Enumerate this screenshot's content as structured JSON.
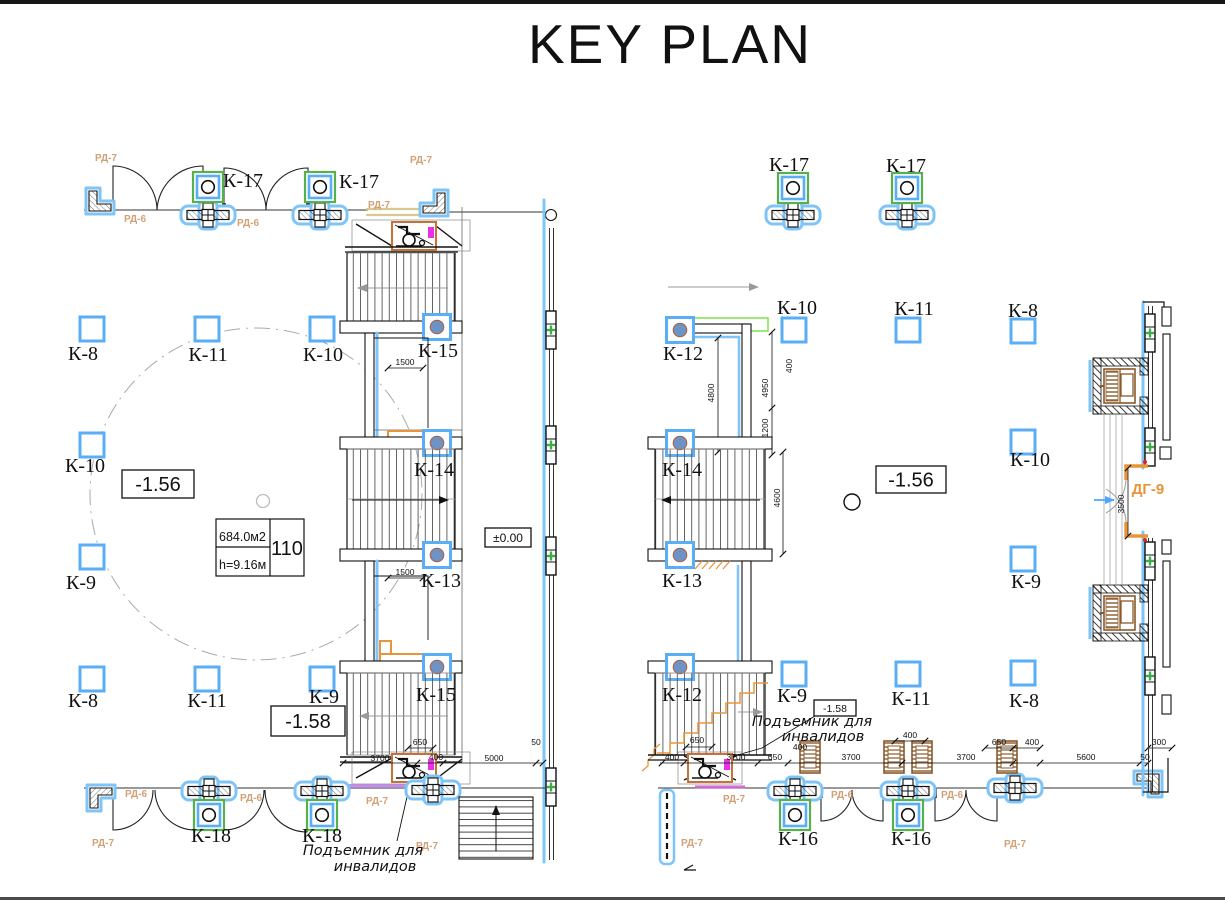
{
  "title": "KEY PLAN",
  "colors": {
    "grid_blue": "#5aaef5",
    "halo_blue": "#7fc4f7",
    "green": "#56b04c",
    "lime": "#7ee24c",
    "tan_label": "#d2a276",
    "tan_wall": "#d8c98e",
    "orange": "#e8953a",
    "brown": "#8B5A2B",
    "magenta": "#e830e8",
    "violet": "#b57edc"
  },
  "room_tag": {
    "area": "684.0м2",
    "height": "h=9.16м",
    "number": "110"
  },
  "elevation_boxes": [
    {
      "text": "-1.56",
      "x": 122,
      "y": 470,
      "w": 72,
      "h": 28,
      "cls": "big"
    },
    {
      "text": "-1.58",
      "x": 271,
      "y": 706,
      "w": 74,
      "h": 30,
      "cls": "big"
    },
    {
      "text": "±0.00",
      "x": 485,
      "y": 528,
      "w": 46,
      "h": 19,
      "cls": "small"
    },
    {
      "text": "-1.56",
      "x": 876,
      "y": 466,
      "w": 70,
      "h": 27,
      "cls": "big"
    },
    {
      "text": "-1.58",
      "x": 814,
      "y": 700,
      "w": 42,
      "h": 16,
      "cls": "tiny"
    }
  ],
  "labels": [
    {
      "t": "К-17",
      "x": 243,
      "y": 187,
      "c": "k"
    },
    {
      "t": "К-17",
      "x": 359,
      "y": 188,
      "c": "k"
    },
    {
      "t": "РД-7",
      "x": 95,
      "y": 161,
      "c": "rd"
    },
    {
      "t": "РД-7",
      "x": 410,
      "y": 163,
      "c": "rd"
    },
    {
      "t": "РД-6",
      "x": 124,
      "y": 222,
      "c": "rd"
    },
    {
      "t": "РД-6",
      "x": 237,
      "y": 226,
      "c": "rd"
    },
    {
      "t": "РД-7",
      "x": 368,
      "y": 208,
      "c": "rd"
    },
    {
      "t": "К-8",
      "x": 83,
      "y": 360,
      "c": "k"
    },
    {
      "t": "К-11",
      "x": 208,
      "y": 361,
      "c": "k"
    },
    {
      "t": "К-10",
      "x": 323,
      "y": 361,
      "c": "k"
    },
    {
      "t": "К-15",
      "x": 438,
      "y": 357,
      "c": "k"
    },
    {
      "t": "К-10",
      "x": 85,
      "y": 472,
      "c": "k"
    },
    {
      "t": "К-14",
      "x": 434,
      "y": 476,
      "c": "k"
    },
    {
      "t": "К-9",
      "x": 81,
      "y": 589,
      "c": "k"
    },
    {
      "t": "К-13",
      "x": 441,
      "y": 587,
      "c": "k"
    },
    {
      "t": "К-8",
      "x": 83,
      "y": 707,
      "c": "k"
    },
    {
      "t": "К-11",
      "x": 207,
      "y": 707,
      "c": "k"
    },
    {
      "t": "К-9",
      "x": 324,
      "y": 703,
      "c": "k"
    },
    {
      "t": "К-15",
      "x": 436,
      "y": 701,
      "c": "k"
    },
    {
      "t": "К-18",
      "x": 211,
      "y": 842,
      "c": "k"
    },
    {
      "t": "К-18",
      "x": 322,
      "y": 842,
      "c": "k"
    },
    {
      "t": "РД-6",
      "x": 125,
      "y": 797,
      "c": "rd"
    },
    {
      "t": "РД-6",
      "x": 240,
      "y": 801,
      "c": "rd"
    },
    {
      "t": "РД-7",
      "x": 366,
      "y": 804,
      "c": "rd"
    },
    {
      "t": "РД-7",
      "x": 92,
      "y": 846,
      "c": "rd"
    },
    {
      "t": "РД-7",
      "x": 416,
      "y": 849,
      "c": "rd"
    },
    {
      "t": "Подъемник для",
      "x": 363,
      "y": 855,
      "c": "hand"
    },
    {
      "t": "инвалидов",
      "x": 375,
      "y": 871,
      "c": "hand"
    },
    {
      "t": "1500",
      "x": 405,
      "y": 365,
      "c": "dim"
    },
    {
      "t": "1500",
      "x": 405,
      "y": 575,
      "c": "dim"
    },
    {
      "t": "650",
      "x": 420,
      "y": 745,
      "c": "dim"
    },
    {
      "t": "3700",
      "x": 380,
      "y": 761,
      "c": "dim"
    },
    {
      "t": "400",
      "x": 436,
      "y": 760,
      "c": "dim"
    },
    {
      "t": "5000",
      "x": 494,
      "y": 761,
      "c": "dim"
    },
    {
      "t": "50",
      "x": 536,
      "y": 745,
      "c": "dim"
    },
    {
      "t": "К-17",
      "x": 789,
      "y": 171,
      "c": "k"
    },
    {
      "t": "К-17",
      "x": 906,
      "y": 172,
      "c": "k"
    },
    {
      "t": "К-10",
      "x": 797,
      "y": 314,
      "c": "k"
    },
    {
      "t": "К-11",
      "x": 914,
      "y": 315,
      "c": "k"
    },
    {
      "t": "К-8",
      "x": 1023,
      "y": 317,
      "c": "k"
    },
    {
      "t": "К-12",
      "x": 683,
      "y": 360,
      "c": "k"
    },
    {
      "t": "К-14",
      "x": 682,
      "y": 476,
      "c": "k"
    },
    {
      "t": "К-10",
      "x": 1030,
      "y": 466,
      "c": "k"
    },
    {
      "t": "К-13",
      "x": 682,
      "y": 587,
      "c": "k"
    },
    {
      "t": "К-9",
      "x": 1026,
      "y": 588,
      "c": "k"
    },
    {
      "t": "К-12",
      "x": 682,
      "y": 701,
      "c": "k"
    },
    {
      "t": "К-9",
      "x": 792,
      "y": 702,
      "c": "k"
    },
    {
      "t": "К-11",
      "x": 911,
      "y": 705,
      "c": "k"
    },
    {
      "t": "К-8",
      "x": 1024,
      "y": 707,
      "c": "k"
    },
    {
      "t": "К-16",
      "x": 798,
      "y": 845,
      "c": "k"
    },
    {
      "t": "К-16",
      "x": 911,
      "y": 845,
      "c": "k"
    },
    {
      "t": "РД-7",
      "x": 723,
      "y": 802,
      "c": "rd"
    },
    {
      "t": "РД-6",
      "x": 831,
      "y": 798,
      "c": "rd"
    },
    {
      "t": "РД-6",
      "x": 941,
      "y": 798,
      "c": "rd"
    },
    {
      "t": "РД-7",
      "x": 681,
      "y": 846,
      "c": "rd"
    },
    {
      "t": "РД-7",
      "x": 1004,
      "y": 847,
      "c": "rd"
    },
    {
      "t": "ДГ-9",
      "x": 1148,
      "y": 494,
      "c": "dg"
    },
    {
      "t": "Подъемник для",
      "x": 812,
      "y": 726,
      "c": "hand"
    },
    {
      "t": "инвалидов",
      "x": 823,
      "y": 741,
      "c": "hand"
    },
    {
      "t": "400",
      "x": 672,
      "y": 760,
      "c": "dim"
    },
    {
      "t": "3700",
      "x": 736,
      "y": 760,
      "c": "dim"
    },
    {
      "t": "650",
      "x": 697,
      "y": 743,
      "c": "dim"
    },
    {
      "t": "650",
      "x": 775,
      "y": 760,
      "c": "dim"
    },
    {
      "t": "400",
      "x": 800,
      "y": 750,
      "c": "dim"
    },
    {
      "t": "3700",
      "x": 851,
      "y": 760,
      "c": "dim"
    },
    {
      "t": "400",
      "x": 910,
      "y": 738,
      "c": "dim"
    },
    {
      "t": "3700",
      "x": 966,
      "y": 760,
      "c": "dim"
    },
    {
      "t": "650",
      "x": 999,
      "y": 745,
      "c": "dim"
    },
    {
      "t": "400",
      "x": 1032,
      "y": 745,
      "c": "dim"
    },
    {
      "t": "5600",
      "x": 1086,
      "y": 760,
      "c": "dim"
    },
    {
      "t": "50",
      "x": 1145,
      "y": 760,
      "c": "dim"
    },
    {
      "t": "300",
      "x": 1159,
      "y": 745,
      "c": "dim"
    },
    {
      "t": "4800",
      "x": 714,
      "y": 393,
      "c": "dimr"
    },
    {
      "t": "4950",
      "x": 768,
      "y": 388,
      "c": "dimr"
    },
    {
      "t": "400",
      "x": 792,
      "y": 366,
      "c": "dimr"
    },
    {
      "t": "1200",
      "x": 768,
      "y": 428,
      "c": "dimr"
    },
    {
      "t": "4600",
      "x": 780,
      "y": 498,
      "c": "dimr"
    },
    {
      "t": "3500",
      "x": 1124,
      "y": 504,
      "c": "dimr"
    }
  ]
}
